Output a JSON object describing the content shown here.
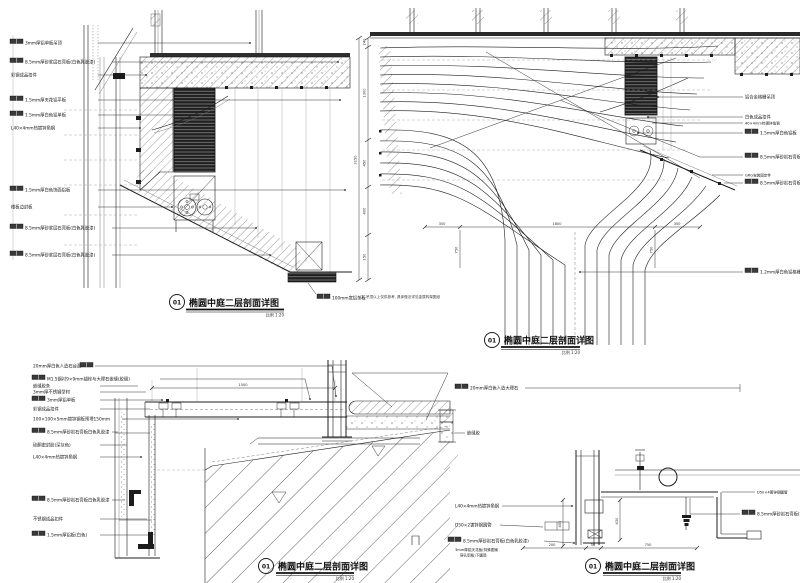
{
  "sheet": {
    "background": "#ffffff",
    "ink": "#1c1c1c",
    "hatch": "#4a4a4a"
  },
  "panels": {
    "tl": {
      "num": "01",
      "title": "椭圆中庭二层剖面详图",
      "scale": "比例 1:20",
      "labels": [
        {
          "box": true,
          "t": "3mm厚铝单板吊顶"
        },
        {
          "box": true,
          "t": "8.5mm厚砂浆层石膏板(白色乳胶漆)"
        },
        {
          "box": false,
          "t": "彩钢成品扣件"
        },
        {
          "box": true,
          "t": "1.5mm厚天花铝平板"
        },
        {
          "box": true,
          "t": "1.5mm厚白色铝单板"
        },
        {
          "box": false,
          "t": "L40×4mm热镀锌角钢"
        },
        {
          "box": true,
          "t": "1.5mm厚白色饰面铝板"
        },
        {
          "box": false,
          "t": "楼板边封板"
        },
        {
          "box": true,
          "t": "8.5mm厚砂浆层石膏板(白色乳胶漆)"
        },
        {
          "box": true,
          "t": "8.5mm厚砂浆层石膏板(白色乳胶漆)"
        },
        {
          "box": true,
          "t": "100mm宽铝条板"
        }
      ]
    },
    "tr": {
      "num": "01",
      "title": "椭圆中庭二层剖面详图",
      "scale": "比例 1:20",
      "note": "注: 吊顶以上仅供参考, 具体做法详见金属构架图纸",
      "labels": [
        {
          "box": false,
          "t": "铝合金格栅吊顶"
        },
        {
          "box": false,
          "t": "白色成品扣件"
        },
        {
          "box": false,
          "t": "40×4mm热镀锌角钢"
        },
        {
          "box": true,
          "t": "1.5mm厚白色铝板"
        },
        {
          "box": true,
          "t": "8.5mm厚砂岩石膏板(白色乳胶漆)"
        },
        {
          "box": false,
          "t": "GRG安装固定件"
        },
        {
          "box": true,
          "t": "8.5mm厚砂岩石膏板(白色乳胶漆)"
        },
        {
          "box": true,
          "t": "1.2mm厚白色铝格栅"
        }
      ],
      "dims_left": [
        "240",
        "1300",
        "450",
        "400",
        "150"
      ],
      "dim_total": "3150",
      "dims_bottom": [
        "350",
        "1800",
        "350"
      ],
      "dims_drop": [
        "750",
        "750"
      ]
    },
    "bl": {
      "num": "01",
      "title": "椭圆中庭二层剖面详图",
      "scale": "比例 1:20",
      "dim_top": "1500",
      "labels": [
        {
          "box": true,
          "t": "20mm厚白色人造石台面"
        },
        {
          "box": true,
          "t": "M1.5钢衬9×9mm锚栓与大理石嵌缝(胶缝)"
        },
        {
          "box": false,
          "t": "嵌缝胶条"
        },
        {
          "box": false,
          "t": "3mm厚不锈钢型材"
        },
        {
          "box": true,
          "t": "3mm厚铝单板"
        },
        {
          "box": false,
          "t": "彩钢成品扣件"
        },
        {
          "box": false,
          "t": "100×100×5mm镀锌钢板预埋150mm"
        },
        {
          "box": true,
          "t": "8.5mm厚砂岩石膏板白色乳胶漆"
        },
        {
          "box": false,
          "t": "硅酮密封胶(深灰色)"
        },
        {
          "box": false,
          "t": "L40×4mm热镀锌角钢"
        },
        {
          "box": true,
          "t": "8.5mm厚砂岩石膏板白色乳胶漆"
        },
        {
          "box": false,
          "t": "不锈钢成品扣件"
        },
        {
          "box": true,
          "t": "1.5mm厚铝板(白色)"
        }
      ]
    },
    "br": {
      "num": "01",
      "title": "椭圆中庭二层剖面详图",
      "scale": "比例 1:20",
      "labels_left": [
        {
          "box": true,
          "t": "20mm厚白色人造大理石"
        },
        {
          "box": false,
          "t": "嵌缝胶"
        },
        {
          "box": false,
          "t": "L40×4mm热镀锌角钢"
        },
        {
          "box": false,
          "t": "D50×2镀锌钢圆管"
        },
        {
          "box": true,
          "t": "8.5mm厚砂岩石膏板(白色乳胶漆)"
        },
        {
          "box": false,
          "t": "3mm厚铝天花板(特殊图案",
          "t2": "穿孔铝板)下圆弧"
        }
      ],
      "labels_right": [
        {
          "box": false,
          "t": "D50×4镀锌钢圆管"
        },
        {
          "box": true,
          "t": "8.5mm厚砂岩石膏板(白色乳胶漆)"
        }
      ],
      "dims_v": [
        "450",
        "430"
      ],
      "dims_bottom": [
        "200",
        "50",
        "750"
      ]
    }
  }
}
